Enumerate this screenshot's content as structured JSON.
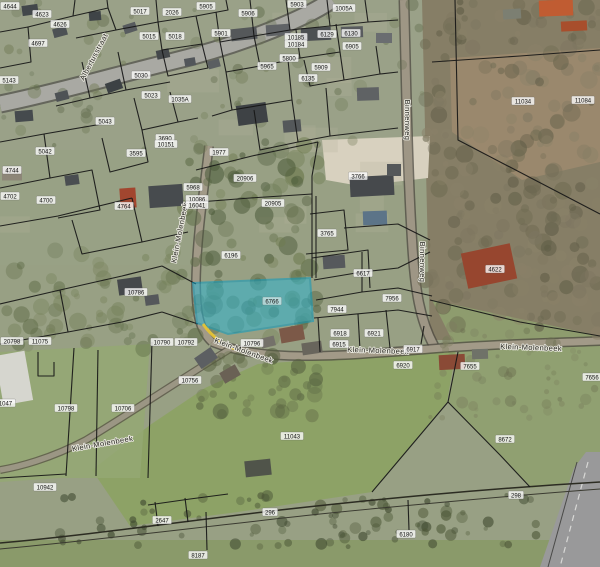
{
  "map": {
    "description": "Aerial cadastral parcel map with highlighted parcel 6766 near Klein-Molenbeek and Binnenweg",
    "colors": {
      "highlight_fill": "#2fb4cf",
      "highlight_stroke": "#0a9cc0",
      "road_highlight": "#e6c437",
      "boundary": "#161616",
      "parcel_label_bg": "#ffffff",
      "parcel_label_text": "#111111",
      "street_label_text": "#26261f"
    },
    "highlighted_parcel": {
      "label": "6766",
      "label_x": 272,
      "label_y": 301,
      "points": "193,283 310,278 313,321 228,334 197,323"
    },
    "street_labels": [
      {
        "t": "Albertusstraat",
        "x": 96,
        "y": 58,
        "r": -62
      },
      {
        "t": "Binnenweg",
        "x": 405,
        "y": 120,
        "r": 90
      },
      {
        "t": "Binnenweg",
        "x": 420,
        "y": 262,
        "r": 90
      },
      {
        "t": "Klein-Molenbeek",
        "x": 182,
        "y": 233,
        "r": -79
      },
      {
        "t": "Klein-Molenbeek",
        "x": 243,
        "y": 353,
        "r": 20
      },
      {
        "t": "Klein-Molenbeek",
        "x": 378,
        "y": 353,
        "r": 2
      },
      {
        "t": "Klein-Molenbeek",
        "x": 531,
        "y": 350,
        "r": 2
      },
      {
        "t": "Klein-Molenbeek",
        "x": 103,
        "y": 446,
        "r": -10
      }
    ],
    "parcel_labels": [
      {
        "t": "4644",
        "x": 10,
        "y": 6
      },
      {
        "t": "4623",
        "x": 42,
        "y": 14
      },
      {
        "t": "4626",
        "x": 60,
        "y": 24
      },
      {
        "t": "4697",
        "x": 38,
        "y": 43
      },
      {
        "t": "5143",
        "x": 9,
        "y": 80
      },
      {
        "t": "5017",
        "x": 140,
        "y": 11
      },
      {
        "t": "2026",
        "x": 172,
        "y": 12
      },
      {
        "t": "5015",
        "x": 149,
        "y": 36
      },
      {
        "t": "5018",
        "x": 175,
        "y": 36
      },
      {
        "t": "5030",
        "x": 141,
        "y": 75
      },
      {
        "t": "5023",
        "x": 151,
        "y": 95
      },
      {
        "t": "1035A",
        "x": 180,
        "y": 99
      },
      {
        "t": "5043",
        "x": 105,
        "y": 121
      },
      {
        "t": "5042",
        "x": 45,
        "y": 151
      },
      {
        "t": "4744",
        "x": 12,
        "y": 170
      },
      {
        "t": "4702",
        "x": 10,
        "y": 196
      },
      {
        "t": "4700",
        "x": 46,
        "y": 200
      },
      {
        "t": "4764",
        "x": 124,
        "y": 206
      },
      {
        "t": "5905",
        "x": 206,
        "y": 6
      },
      {
        "t": "5906",
        "x": 248,
        "y": 13
      },
      {
        "t": "5903",
        "x": 297,
        "y": 4
      },
      {
        "t": "5901",
        "x": 221,
        "y": 33
      },
      {
        "t": "10185",
        "x": 296,
        "y": 37
      },
      {
        "t": "10184",
        "x": 296,
        "y": 44
      },
      {
        "t": "6129",
        "x": 327,
        "y": 34
      },
      {
        "t": "6130",
        "x": 351,
        "y": 33
      },
      {
        "t": "1005A",
        "x": 344,
        "y": 8
      },
      {
        "t": "6905",
        "x": 352,
        "y": 46
      },
      {
        "t": "5800",
        "x": 289,
        "y": 58
      },
      {
        "t": "5965",
        "x": 267,
        "y": 66
      },
      {
        "t": "5909",
        "x": 321,
        "y": 67
      },
      {
        "t": "6135",
        "x": 308,
        "y": 78
      },
      {
        "t": "3690",
        "x": 165,
        "y": 138
      },
      {
        "t": "10151",
        "x": 166,
        "y": 144
      },
      {
        "t": "3595",
        "x": 136,
        "y": 153
      },
      {
        "t": "1977",
        "x": 219,
        "y": 152
      },
      {
        "t": "20906",
        "x": 245,
        "y": 178
      },
      {
        "t": "5968",
        "x": 193,
        "y": 187
      },
      {
        "t": "10086",
        "x": 197,
        "y": 199
      },
      {
        "t": "16041",
        "x": 197,
        "y": 205
      },
      {
        "t": "20905",
        "x": 273,
        "y": 203
      },
      {
        "t": "6196",
        "x": 231,
        "y": 255
      },
      {
        "t": "10786",
        "x": 136,
        "y": 292
      },
      {
        "t": "3766",
        "x": 358,
        "y": 176
      },
      {
        "t": "3765",
        "x": 327,
        "y": 233
      },
      {
        "t": "6617",
        "x": 363,
        "y": 273
      },
      {
        "t": "11034",
        "x": 523,
        "y": 101
      },
      {
        "t": "11084",
        "x": 583,
        "y": 100
      },
      {
        "t": "4622",
        "x": 495,
        "y": 269
      },
      {
        "t": "7956",
        "x": 392,
        "y": 298
      },
      {
        "t": "7944",
        "x": 337,
        "y": 309
      },
      {
        "t": "6918",
        "x": 340,
        "y": 333
      },
      {
        "t": "6921",
        "x": 374,
        "y": 333
      },
      {
        "t": "6915",
        "x": 339,
        "y": 344
      },
      {
        "t": "6917",
        "x": 413,
        "y": 349
      },
      {
        "t": "6920",
        "x": 403,
        "y": 365
      },
      {
        "t": "7655",
        "x": 470,
        "y": 366
      },
      {
        "t": "7656",
        "x": 592,
        "y": 377
      },
      {
        "t": "20798",
        "x": 12,
        "y": 341
      },
      {
        "t": "11075",
        "x": 40,
        "y": 341
      },
      {
        "t": "10790",
        "x": 162,
        "y": 342
      },
      {
        "t": "10792",
        "x": 186,
        "y": 342
      },
      {
        "t": "10796",
        "x": 252,
        "y": 343
      },
      {
        "t": "10756",
        "x": 190,
        "y": 380
      },
      {
        "t": "10798",
        "x": 66,
        "y": 408
      },
      {
        "t": "10706",
        "x": 123,
        "y": 408
      },
      {
        "t": "11047",
        "x": 4,
        "y": 403
      },
      {
        "t": "10942",
        "x": 45,
        "y": 487
      },
      {
        "t": "11043",
        "x": 292,
        "y": 436
      },
      {
        "t": "8672",
        "x": 505,
        "y": 439
      },
      {
        "t": "2647",
        "x": 162,
        "y": 520
      },
      {
        "t": "296",
        "x": 270,
        "y": 512
      },
      {
        "t": "298",
        "x": 516,
        "y": 495
      },
      {
        "t": "8187",
        "x": 198,
        "y": 555
      },
      {
        "t": "6180",
        "x": 406,
        "y": 534
      }
    ]
  }
}
